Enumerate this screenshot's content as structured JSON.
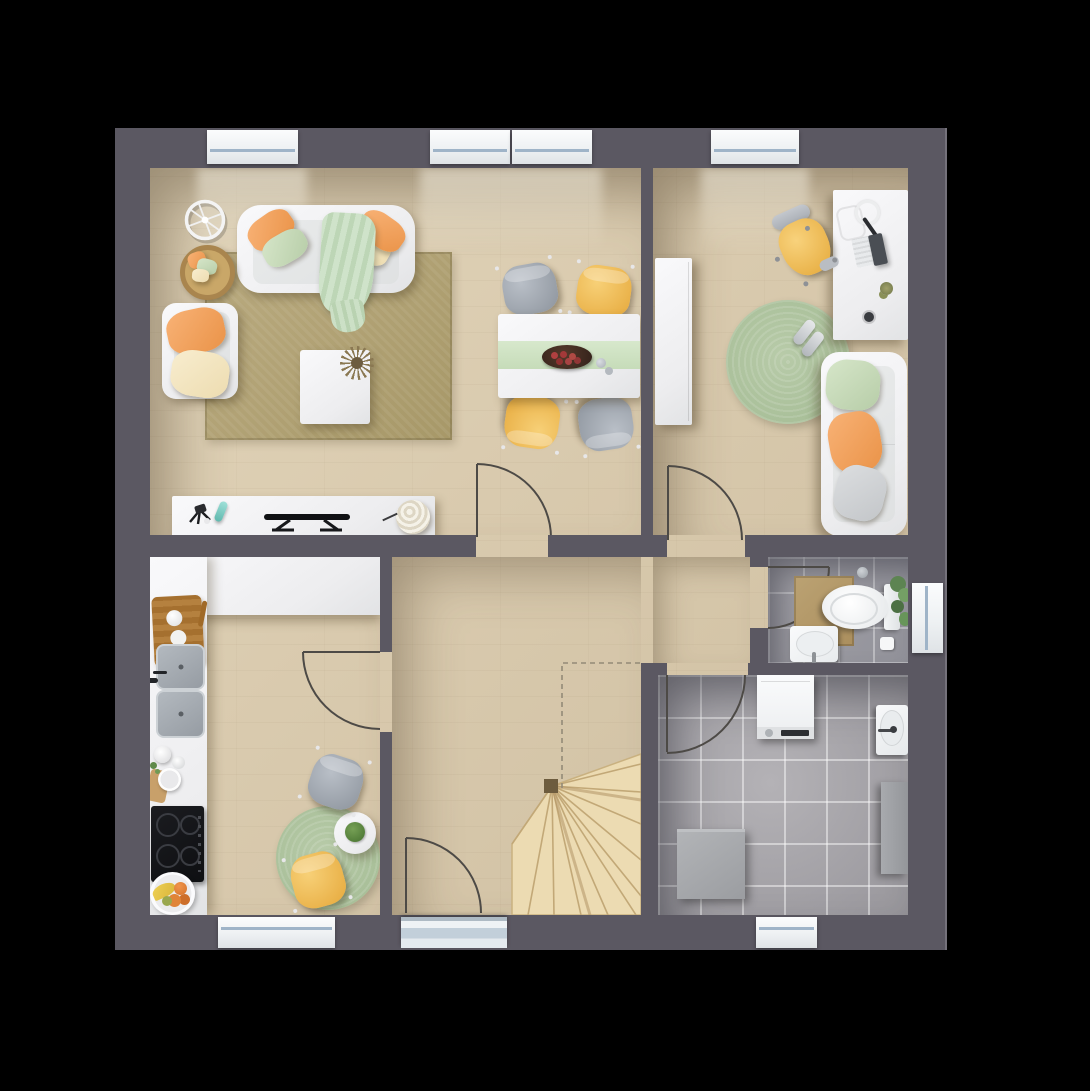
{
  "meta": {
    "title": "Ground-floor plan, top-down 3D architectural render",
    "view": "top-down",
    "background": "#000000"
  },
  "palette": {
    "wall": "#5b5862",
    "floor_wood": "#d9caae",
    "floor_tile_bathroom": "#97969c",
    "floor_tile_utility": "#a7a5a9",
    "stairs": "#ecdbb2",
    "rug_tan": "#b1a277",
    "rug_sage": "#adc3a0",
    "furniture_white": "#f2f2f4",
    "accent_orange": "#f2a25e",
    "accent_yellow": "#f0c05e",
    "accent_mint": "#c9dfc2",
    "chair_gray": "#9aa2ab",
    "window_glass": "#9fb4c8",
    "door_line": "#4d4a46"
  },
  "rooms": [
    {
      "id": "living-room",
      "label": "Living room",
      "floor": "wood",
      "furniture": [
        "three-seat-sofa",
        "throw-blanket",
        "armchair",
        "pillow-basket",
        "wall-wheel-decor",
        "tan-area-rug",
        "coffee-table-with-plant",
        "tv-sideboard"
      ]
    },
    {
      "id": "dining-area",
      "label": "Dining area",
      "floor": "wood",
      "furniture": [
        "dining-table",
        "mint-table-runner",
        "fruit-bowl",
        "chair-gray",
        "chair-yellow",
        "chair-yellow",
        "chair-gray"
      ]
    },
    {
      "id": "home-office",
      "label": "Home office / guest room",
      "floor": "wood",
      "furniture": [
        "wardrobe",
        "desk",
        "laptop",
        "keyboard",
        "headphones",
        "desk-chair-yellow",
        "round-sage-rug",
        "shoes",
        "two-seat-sofa"
      ]
    },
    {
      "id": "kitchen",
      "label": "Kitchen with dining nook",
      "floor": "wood",
      "furniture": [
        "l-shaped-counter",
        "cutting-board",
        "double-sink",
        "dish-set",
        "cooktop",
        "fruit-plate",
        "round-sage-rug",
        "bistro-table-with-plant",
        "chair-gray",
        "chair-yellow"
      ]
    },
    {
      "id": "hallway",
      "label": "Hallway / entry",
      "floor": "wood",
      "furniture": []
    },
    {
      "id": "staircase",
      "label": "Winder staircase",
      "floor": "wood",
      "furniture": [
        "stairs",
        "floor-opening-dashed-outline"
      ]
    },
    {
      "id": "bathroom",
      "label": "Bathroom / WC",
      "floor": "tile",
      "furniture": [
        "toilet",
        "washbasin",
        "bath-mat",
        "toilet-paper",
        "hanging-plant"
      ]
    },
    {
      "id": "utility-room",
      "label": "Utility room",
      "floor": "tile",
      "furniture": [
        "washing-machine",
        "utility-sink",
        "tall-cabinet",
        "storage-box"
      ]
    }
  ],
  "openings": {
    "windows": [
      "living-top",
      "dining-top-left",
      "dining-top-right",
      "office-top",
      "kitchen-bottom",
      "utility-bottom",
      "bathroom-right"
    ],
    "doors": [
      "front-entry",
      "hall-to-living-dining",
      "hall-to-kitchen",
      "hall-to-office",
      "hall-to-bathroom",
      "hall-to-utility"
    ]
  }
}
